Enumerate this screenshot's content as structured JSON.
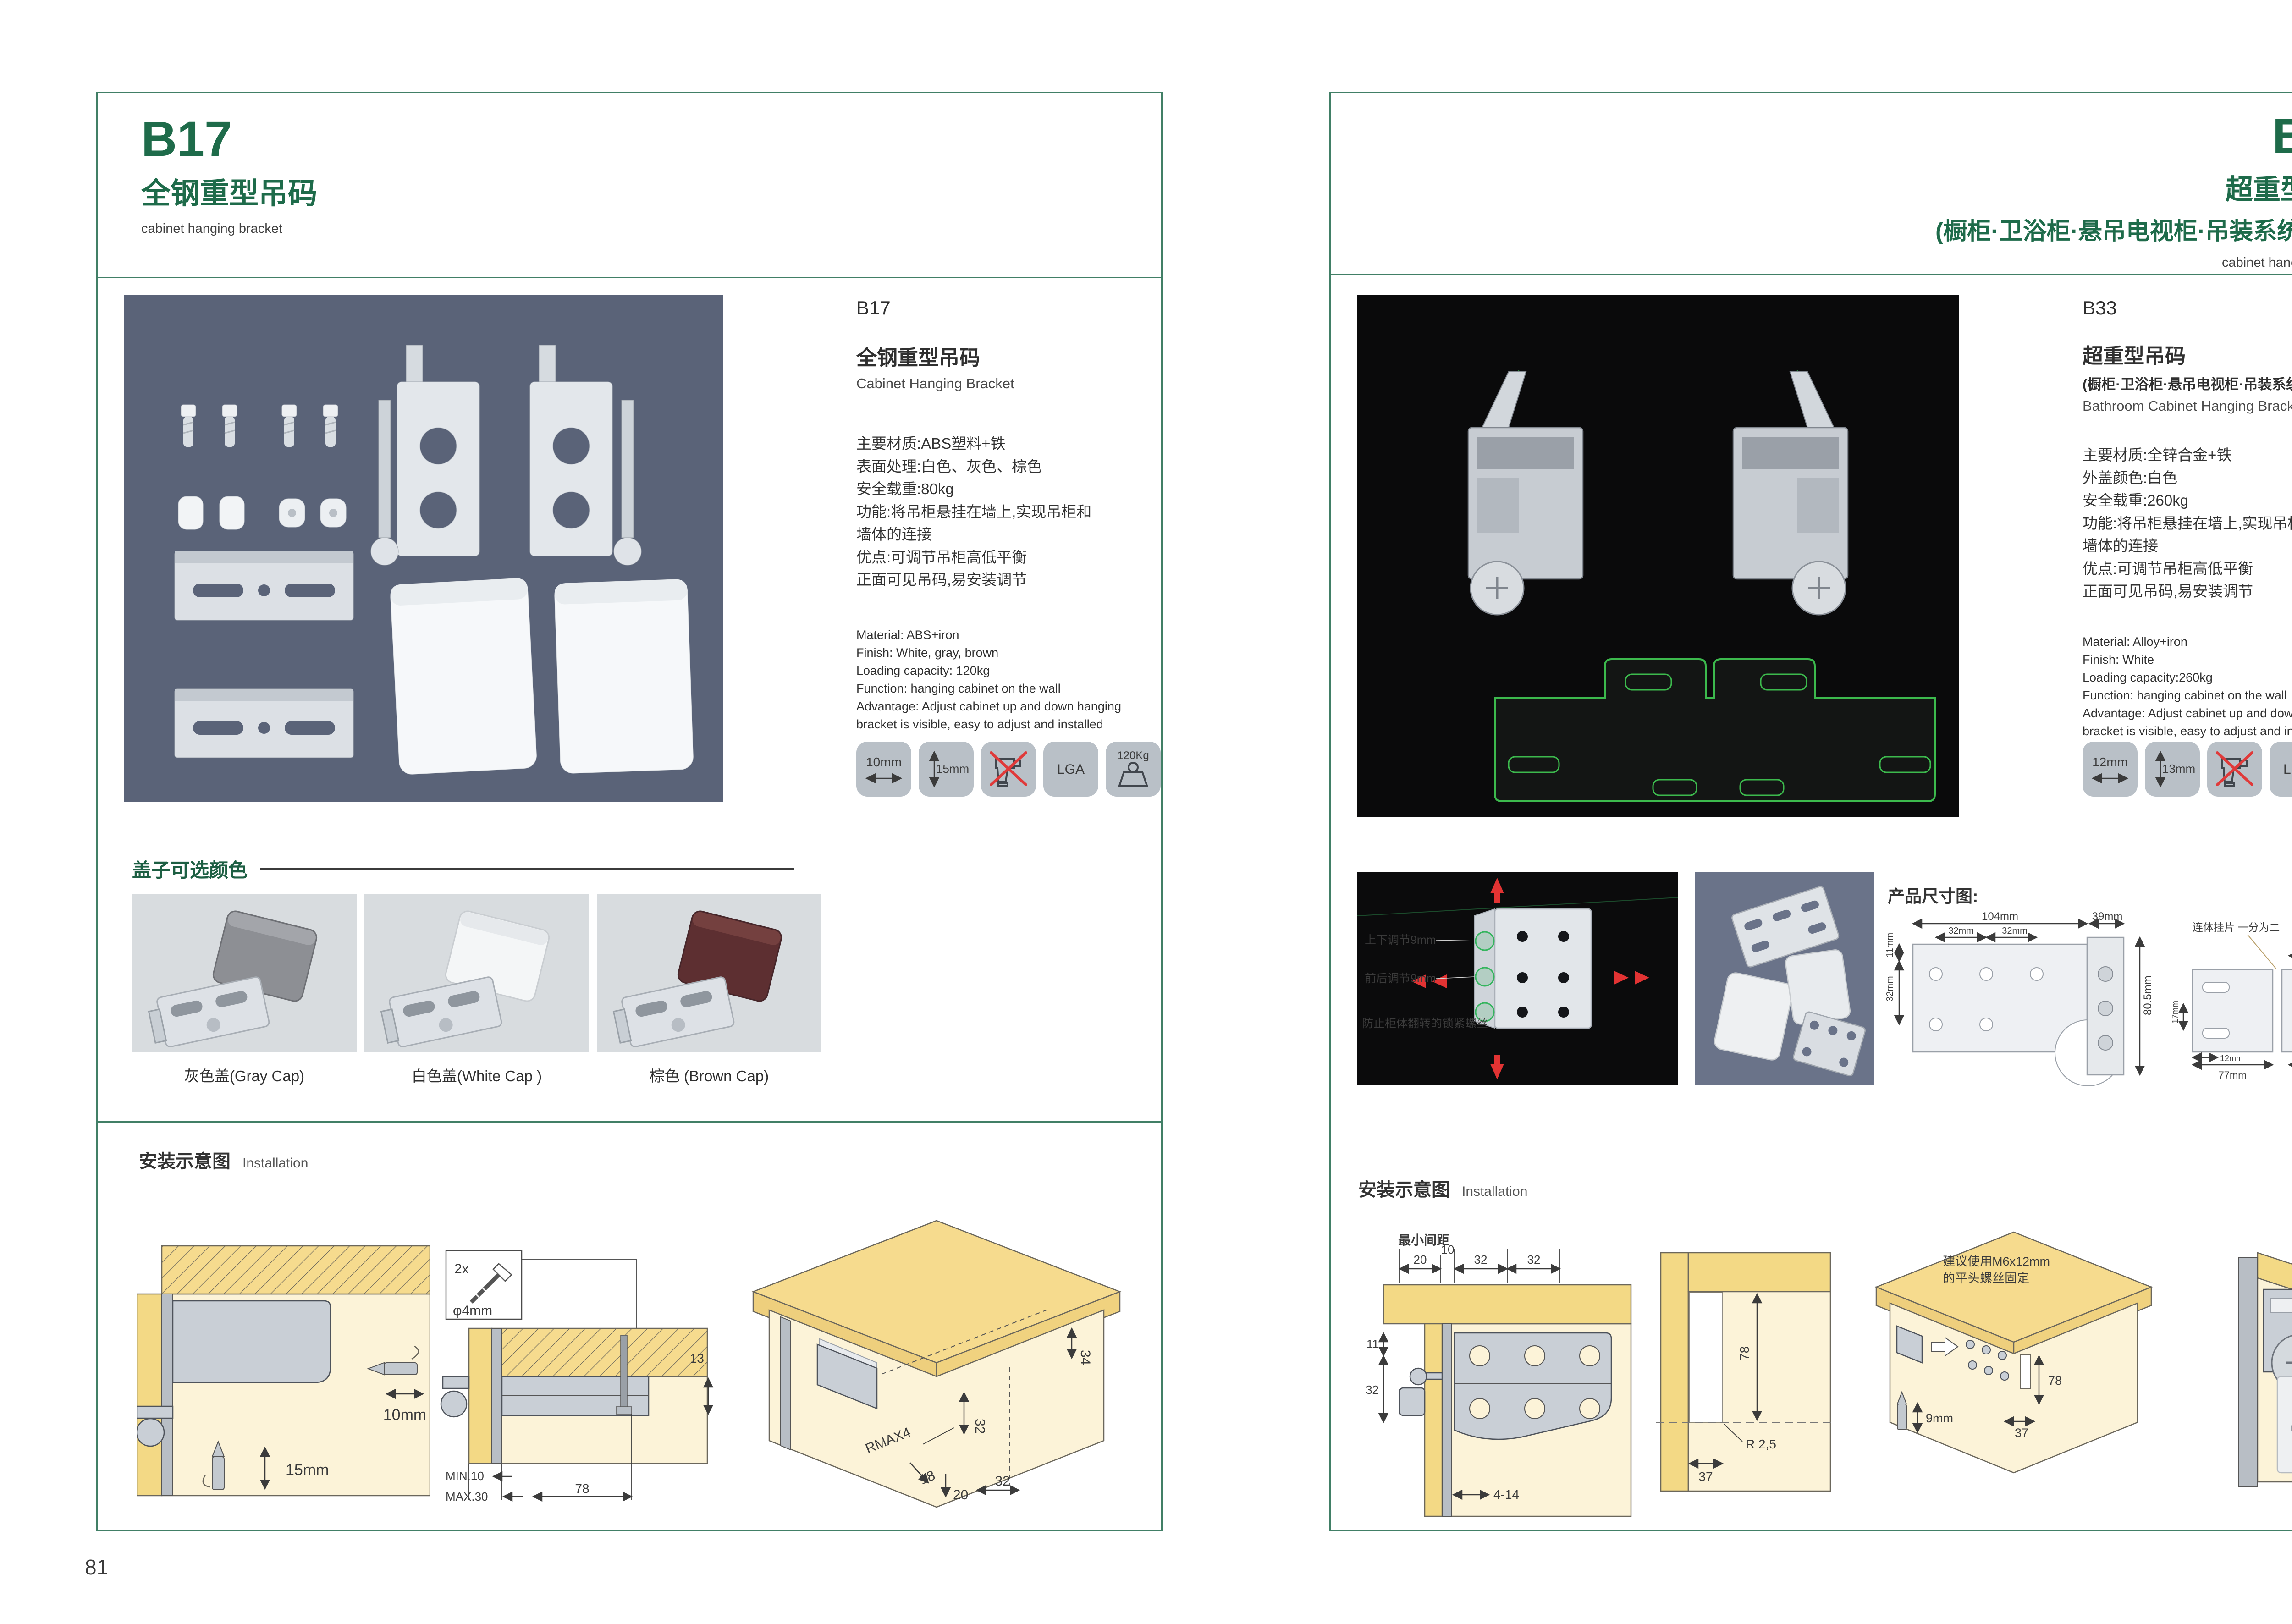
{
  "brand": {
    "green": "#1e6b4a",
    "border": "#417f66"
  },
  "page_left": {
    "page_number": "81",
    "header": {
      "code": "B17",
      "title": "全钢重型吊码",
      "tagline": "cabinet hanging bracket"
    },
    "info": {
      "code": "B17",
      "name_cn": "全钢重型吊码",
      "name_en": "Cabinet Hanging Bracket",
      "specs_cn": [
        "主要材质:ABS塑料+铁",
        "表面处理:白色、灰色、棕色",
        "安全载重:80kg",
        "功能:将吊柜悬挂在墙上,实现吊柜和",
        "墙体的连接",
        "优点:可调节吊柜高低平衡",
        "正面可见吊码,易安装调节"
      ],
      "specs_en": [
        "Material: ABS+iron",
        "Finish: White, gray, brown",
        "Loading capacity: 120kg",
        "Function: hanging cabinet on the wall",
        "Advantage: Adjust cabinet up and down hanging",
        "bracket is visible, easy to adjust and installed"
      ],
      "icons": {
        "width": "10mm",
        "height": "15mm",
        "cert": "LGA",
        "load": "120Kg"
      }
    },
    "caps": {
      "heading": "盖子可选颜色",
      "items": [
        "灰色盖(Gray Cap)",
        "白色盖(White Cap )",
        "棕色 (Brown Cap)"
      ]
    },
    "install": {
      "heading": "安装示意图",
      "sub": "Installation",
      "d1": {
        "w": "10mm",
        "h": "15mm"
      },
      "d2": {
        "qty": "2x",
        "dia": "φ4mm",
        "gap": "13",
        "min": "MIN.10",
        "max": "MAX.30",
        "len": "78"
      },
      "d3": {
        "a": "34",
        "b": "32",
        "r": "RMAX4",
        "c": "18",
        "d": "20",
        "e": "32"
      }
    }
  },
  "page_right": {
    "page_number": "82",
    "header": {
      "code": "B33",
      "title": "超重型吊码",
      "subtitle": "(橱柜·卫浴柜·悬吊电视柜·吊装系统 专用)",
      "tagline": "cabinet hanging bracket"
    },
    "info": {
      "code": "B33",
      "name_cn": "超重型吊码",
      "name_sub": "(橱柜·卫浴柜·悬吊电视柜·吊装系统 专用)",
      "name_en": "Bathroom Cabinet Hanging Bracket",
      "specs_cn": [
        "主要材质:全锌合金+铁",
        "外盖颜色:白色",
        "安全载重:260kg",
        "功能:将吊柜悬挂在墙上,实现吊柜和",
        "墙体的连接",
        "优点:可调节吊柜高低平衡",
        "正面可见吊码,易安装调节"
      ],
      "specs_en": [
        "Material: Alloy+iron",
        "Finish: White",
        "Loading capacity:260kg",
        "Function: hanging cabinet on the wall",
        "Advantage: Adjust cabinet up and down hanging",
        "bracket is visible, easy to adjust and installed"
      ],
      "icons": {
        "width": "12mm",
        "height": "13mm",
        "cert": "LGA",
        "load": "260Kg"
      }
    },
    "feature_photo": {
      "labels": [
        "上下调节9mm",
        "前后调节9mm",
        "防止柜体翻转的锁紧螺丝"
      ]
    },
    "dims": {
      "heading": "产品尺寸图:",
      "note": "连体挂片 一分为二",
      "labels": {
        "w": "104mm",
        "p1": "32mm",
        "p2": "32mm",
        "side": "39mm",
        "e1": "11mm",
        "e2": "32mm",
        "h": "80.5mm",
        "t17": "17mm",
        "t12": "12mm",
        "t77": "77mm",
        "t55a": "55mm",
        "t39": "39mm",
        "t55b": "55mm",
        "t8": "8mm",
        "t63": "63mm"
      }
    },
    "install": {
      "heading": "安装示意图",
      "sub": "Installation",
      "d1": {
        "min": "最小间距",
        "a": "20",
        "b": "10",
        "c": "32",
        "d": "32",
        "e": "11",
        "f": "32",
        "g": "4-14"
      },
      "d2": {
        "a": "78",
        "b": "R 2,5",
        "c": "37"
      },
      "d3": {
        "note1": "建议使用M6x12mm",
        "note2": "的平头螺丝固定",
        "a": "78",
        "b": "37",
        "c": "9mm"
      }
    }
  }
}
